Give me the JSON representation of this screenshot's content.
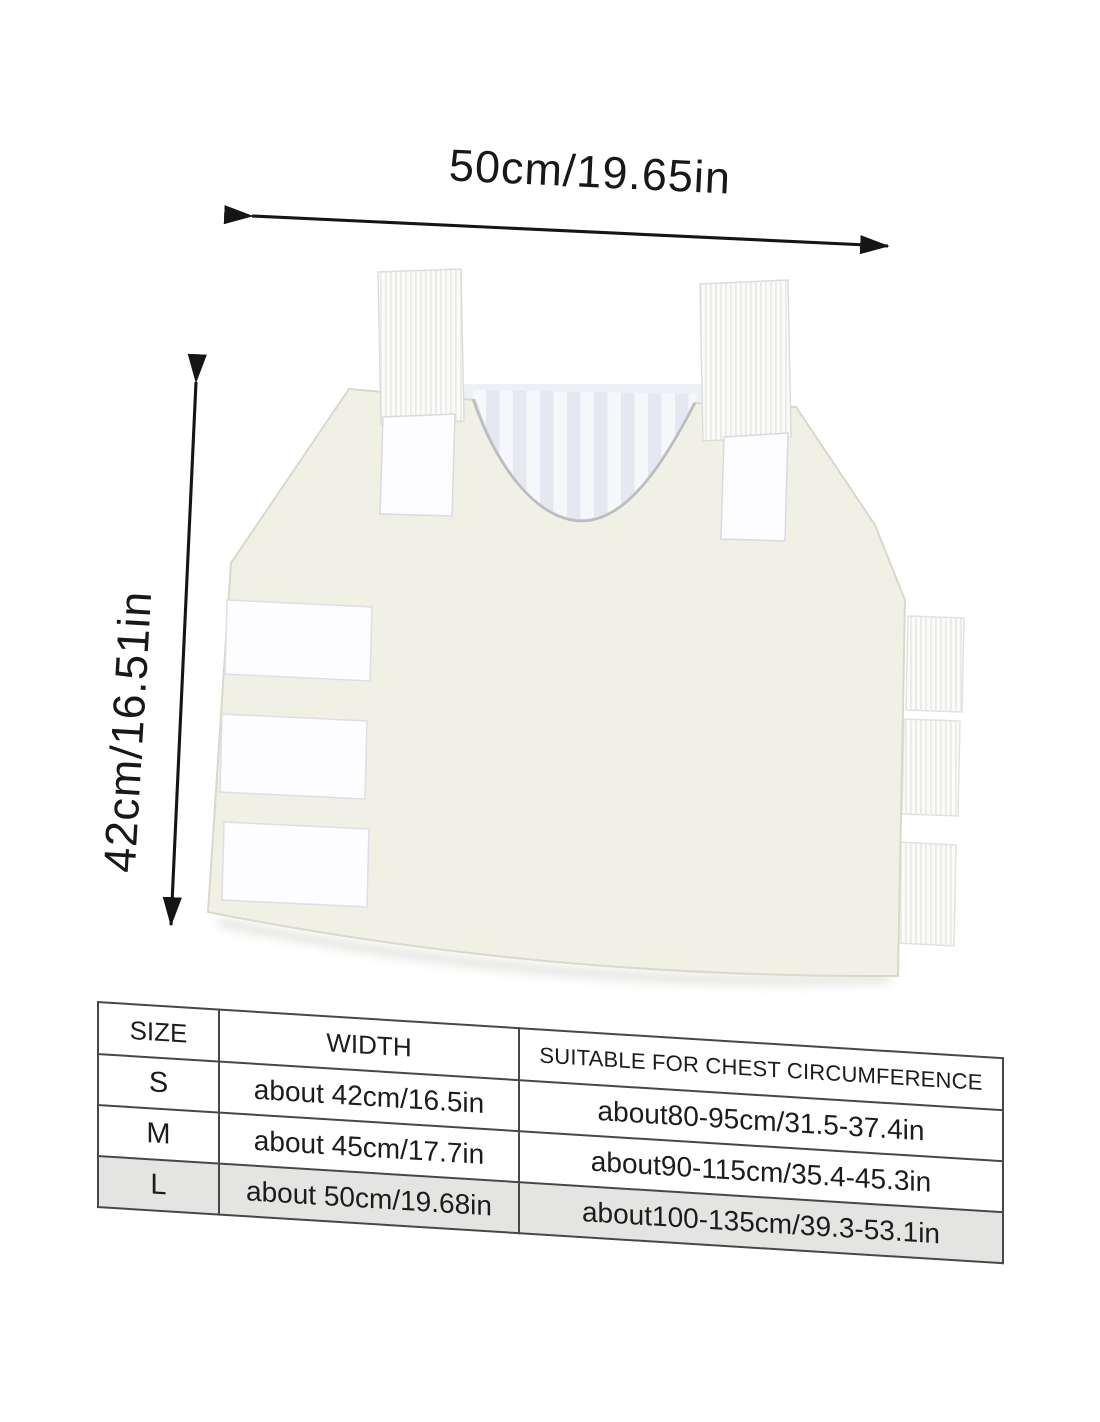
{
  "annotations": {
    "width_dimension": "50cm/19.65in",
    "height_dimension": "42cm/16.51in",
    "arrow_color": "#151515"
  },
  "size_table": {
    "headers": {
      "size": "SIZE",
      "width": "WIDTH",
      "chest": "SUITABLE FOR CHEST CIRCUMFERENCE"
    },
    "rows": [
      {
        "size": "S",
        "width": "about 42cm/16.5in",
        "chest": "about80-95cm/31.5-37.4in"
      },
      {
        "size": "M",
        "width": "about 45cm/17.7in",
        "chest": "about90-115cm/35.4-45.3in"
      },
      {
        "size": "L",
        "width": "about 50cm/19.68in",
        "chest": "about100-135cm/39.3-53.1in"
      }
    ],
    "highlighted_row": "L",
    "highlight_color": "#e4e4e2",
    "border_color": "#474747"
  },
  "product": {
    "image_label": "white-protective-vest-front-panel",
    "colors": {
      "body": "#f1f0e5",
      "strap_webbing": "#fbfbfa",
      "velcro": "#fdfdff",
      "lining_stripe_light": "#f6f7fb",
      "lining_stripe_dark": "#e6e8f1",
      "background": "#ffffff"
    }
  }
}
